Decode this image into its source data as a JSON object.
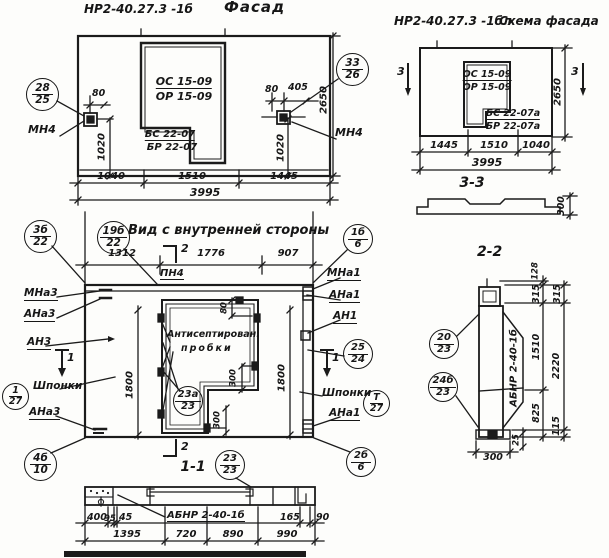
{
  "facade": {
    "code": "НР2-40.27.3 -1б",
    "title": "Фасад",
    "win_top1": "ОС 15-09",
    "win_top2": "ОР 15-09",
    "win_bot1": "БС 22-07",
    "win_bot2": "БР 22-07",
    "mn4_left": "МН4",
    "mn4_right": "МН4",
    "balloon_left": {
      "num": "28",
      "den": "25"
    },
    "balloon_right": {
      "num": "33",
      "den": "26"
    },
    "dim_80l": "80",
    "dim_80r": "80",
    "dim_405": "405",
    "dim_1020l": "1020",
    "dim_1020r": "1020",
    "dim_2650": "2650",
    "dim_b1": "1040",
    "dim_b2": "1510",
    "dim_b3": "1445",
    "dim_total": "3995"
  },
  "scheme": {
    "code": "НР2-40.27.3 -1бл",
    "title": "Схема фасада",
    "win_top1": "ОС 15-09",
    "win_top2": "ОР 15-09",
    "win_bot1": "БС 22-07а",
    "win_bot2": "БР 22-07а",
    "sec_left": "3",
    "sec_right": "3",
    "dim_2650": "2650",
    "dim_b1": "1445",
    "dim_b2": "1510",
    "dim_b3": "1040",
    "dim_total": "3995",
    "sec33_title": "3-3",
    "dim_300": "300"
  },
  "inner": {
    "title": "Вид с внутренней стороны",
    "dim_t1": "1312",
    "dim_t2": "1776",
    "dim_t3": "907",
    "pn4": "ПН4",
    "sec2_top": "2",
    "sec2_bot": "2",
    "sec1_left": "1",
    "sec1_right": "1",
    "mna3": "МНа3",
    "ana3_top": "АНа3",
    "an3": "АН3",
    "shponki_left": "Шпонки",
    "ana3_bot": "АНа3",
    "mna1": "МНа1",
    "ana1_top": "АНа1",
    "an1": "АН1",
    "shponki_right": "Шпонки",
    "ana1_bot": "АНа1",
    "plugs1": "Антисептирован.",
    "plugs2": "пробки",
    "dim_1800l": "1800",
    "dim_1800r": "1800",
    "dim_80": "80",
    "dim_300a": "300",
    "dim_300b": "300",
    "sec11_title": "1-1",
    "balloon_tl": {
      "num": "3б",
      "den": "8"
    },
    "balloon_tm": {
      "num": "19б",
      "den": "22"
    },
    "balloon_tr": {
      "num": "1б",
      "den": "6"
    },
    "balloon_keys_l": {
      "num": "1",
      "den": "27"
    },
    "balloon_23a": {
      "num": "23а",
      "den": "23"
    },
    "balloon_25": {
      "num": "25",
      "den": "24"
    },
    "balloon_keys_r": {
      "num": "Т",
      "den": "27"
    },
    "balloon_bl": {
      "num": "4б",
      "den": "10"
    },
    "balloon_br": {
      "num": "2б",
      "den": "6"
    },
    "balloon_23": {
      "num": "23",
      "den": "23"
    }
  },
  "s11": {
    "label": "АБНР 2-40-1б",
    "d400": "400",
    "d95": "95",
    "d45": "45",
    "d165": "165",
    "d90": "90",
    "d1395": "1395",
    "d720": "720",
    "d890": "890",
    "d990": "990"
  },
  "s22": {
    "title": "2-2",
    "label": "АБНР 2-40-1б",
    "d128": "128",
    "d315a": "315",
    "d1510": "1510",
    "d825": "825",
    "d25": "25",
    "d315b": "315",
    "d2220": "2220",
    "d115": "115",
    "d300": "300",
    "balloon_20": {
      "num": "20",
      "den": "23"
    },
    "balloon_24b": {
      "num": "24б",
      "den": "23"
    }
  }
}
